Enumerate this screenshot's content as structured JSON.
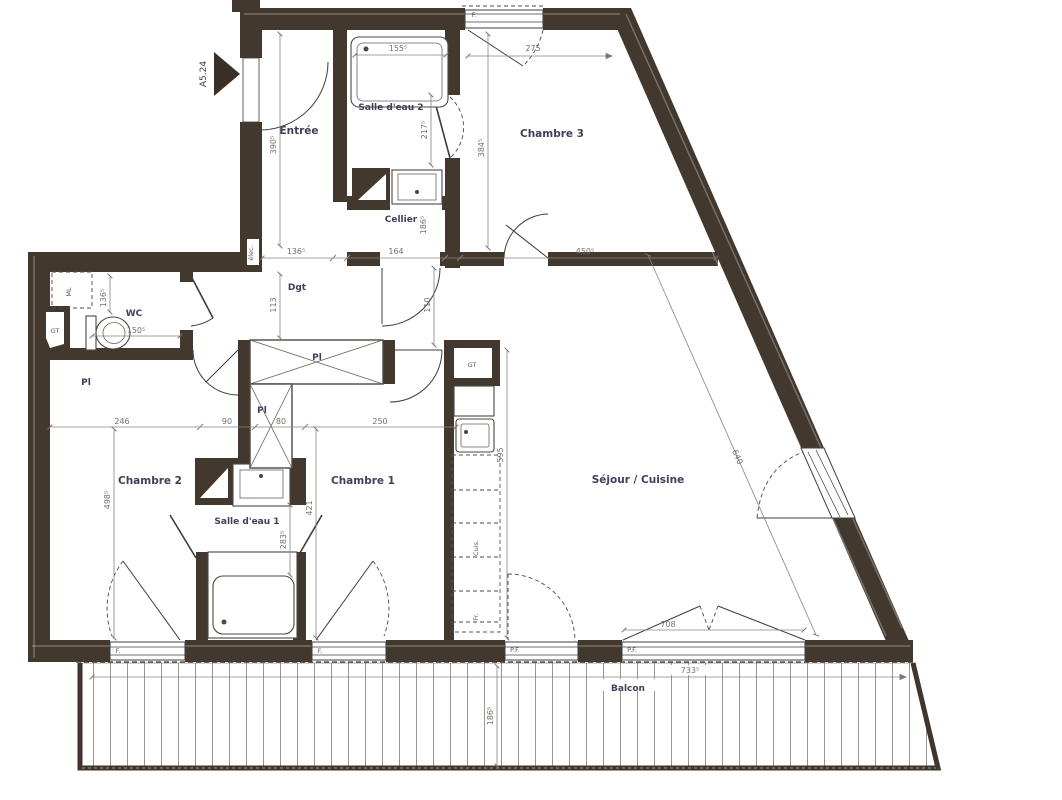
{
  "colors": {
    "wall": "#43382e",
    "line": "#3c3c3c",
    "dim_line": "#8a837b",
    "dim_text": "#73706c",
    "room_text": "#3f3f58"
  },
  "marker": {
    "label": "A5.24"
  },
  "rooms": {
    "entree": "Entrée",
    "salle_eau_2": "Salle d'eau 2",
    "chambre_3": "Chambre 3",
    "cellier": "Cellier",
    "dgt": "Dgt",
    "wc": "WC",
    "pl_a": "Pl",
    "pl_b": "Pl",
    "pl_c": "Pl",
    "chambre_2": "Chambre 2",
    "chambre_1": "Chambre 1",
    "salle_eau_1": "Salle d'eau 1",
    "sejour": "Séjour / Cuisine",
    "balcon": "Balcon"
  },
  "fixtures": {
    "gt_wc": "GT",
    "gt_cuisine": "GT",
    "ml": "ML",
    "elec": "élec.",
    "cuisine": "Cuis.",
    "frigo": "Fr."
  },
  "openings": {
    "f_top": "F.",
    "f_ch2": "F.",
    "f_ch1": "F.",
    "pf_1": "P.F.",
    "pf_2": "P.F."
  },
  "dims": {
    "tub2": "155⁵",
    "ch3_top": "275",
    "ch3_h": "384⁵",
    "ch3_w": "450⁵",
    "sde2_h": "217⁵",
    "entree_h": "390⁵",
    "dgt_w": "136⁵",
    "cellier_w": "164",
    "cellier_h": "186⁵",
    "dgt_h": "113",
    "dgt_h2": "110",
    "wc_w": "150⁵",
    "wc_h": "136⁵",
    "ch2_w": "246",
    "hall_w": "90",
    "pl_w": "80",
    "ch1_w": "250",
    "ch2_h": "498⁵",
    "sde1_h": "283⁵",
    "pl_h": "421",
    "sejour_h": "595",
    "pf_w": "708",
    "balcon_w": "733⁵",
    "balcon_d": "186⁵",
    "diag": "640"
  }
}
